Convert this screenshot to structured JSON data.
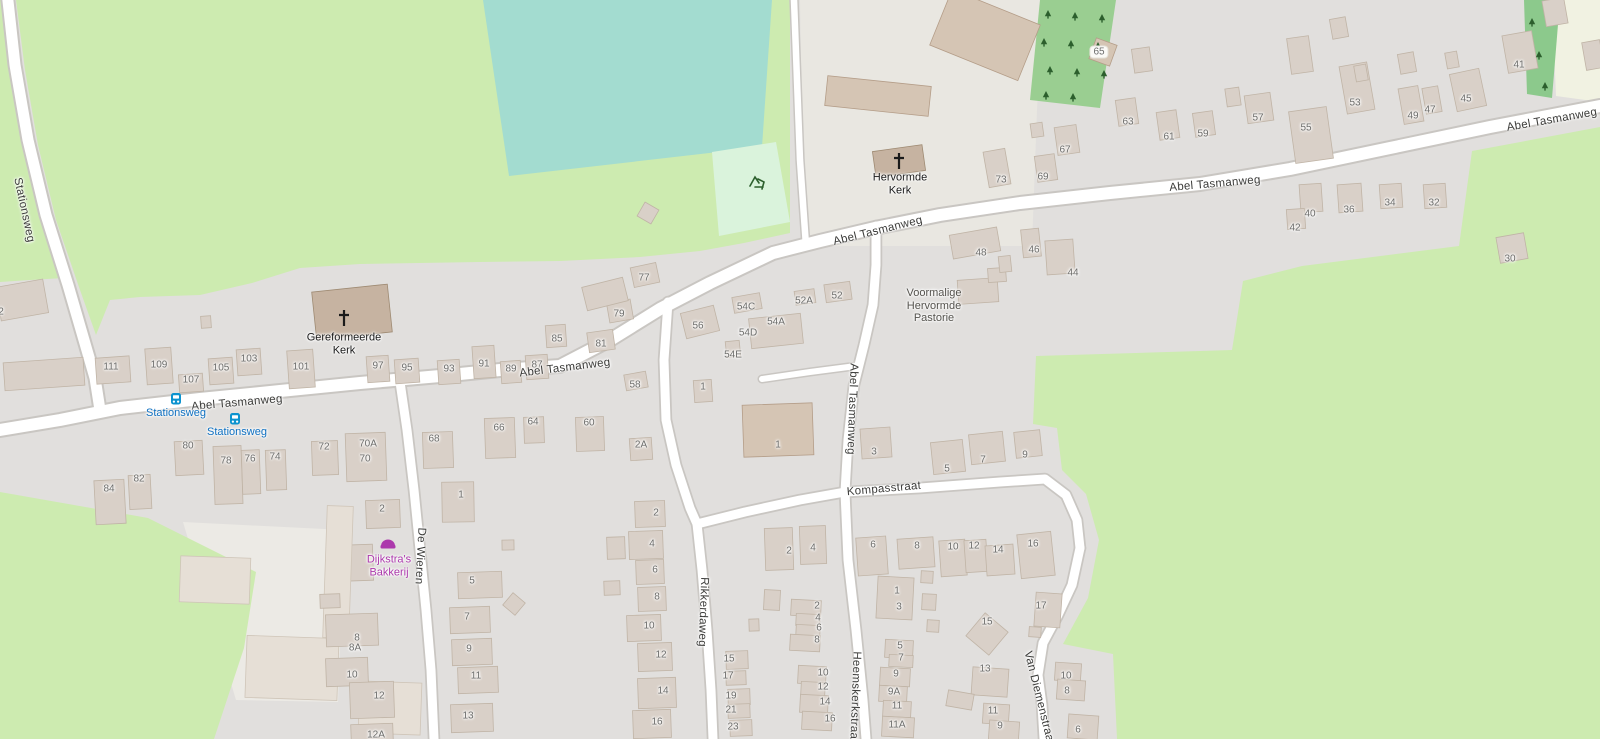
{
  "map": {
    "colors": {
      "residential": "#e1dfdd",
      "grass": "#cdebb0",
      "pitch": "#a3dcd0",
      "playground": "#daf3dc",
      "orchard": "#9ace91",
      "tree_strip": "#8cc98c",
      "tree_glyph": "#2c5f2d",
      "farmyard": "#e9e7e1",
      "farmland": "#f1f2e2",
      "yard": "#eceae5",
      "road_fill": "#ffffff",
      "road_casing": "#c9c6c2",
      "building_fill": "#d9d0c8",
      "building_stroke": "#c0b4a6",
      "shed_fill": "#d5c5b4",
      "shed_stroke": "#b49d88",
      "church_fill": "#c6b3a1",
      "church_stroke": "#9e8a72",
      "pale_fill": "#e6dfd6",
      "pale_stroke": "#cfc5b8",
      "street_text": "#3b3b39",
      "housenumber_text": "#6c6c6a",
      "church_text": "#1a1a1a",
      "site_text": "#54524d",
      "shop_purple": "#ac39ac",
      "bus_icon_blue": "#0c93cf",
      "bus_text_blue": "#0d6fc0"
    },
    "street_labels": [
      {
        "text": "Stationsweg",
        "x": 24,
        "y": 210,
        "rot": 78
      },
      {
        "text": "Abel Tasmanweg",
        "x": 237,
        "y": 403,
        "rot": -5
      },
      {
        "text": "Abel Tasmanweg",
        "x": 565,
        "y": 368,
        "rot": -7
      },
      {
        "text": "Abel Tasmanweg",
        "x": 878,
        "y": 231,
        "rot": -14
      },
      {
        "text": "Abel Tasmanweg",
        "x": 1215,
        "y": 184,
        "rot": -5
      },
      {
        "text": "Abel Tasmanweg",
        "x": 1552,
        "y": 120,
        "rot": -10
      },
      {
        "text": "Abel Tasmanweg",
        "x": 852,
        "y": 409,
        "rot": 92
      },
      {
        "text": "Kompasstraat",
        "x": 884,
        "y": 489,
        "rot": -5
      },
      {
        "text": "Rikkerdaweg",
        "x": 703,
        "y": 612,
        "rot": 92
      },
      {
        "text": "De Wieren",
        "x": 420,
        "y": 556,
        "rot": 93
      },
      {
        "text": "Heemskerkstraat",
        "x": 855,
        "y": 697,
        "rot": 92
      },
      {
        "text": "Van Diemenstraat",
        "x": 1039,
        "y": 698,
        "rot": 76
      }
    ],
    "pois": [
      {
        "id": "gereformeerde-kerk",
        "lines": [
          "Gereformeerde",
          "Kerk"
        ],
        "x": 344,
        "y": 344,
        "color": "church_text",
        "icon": "cross",
        "icon_x": 344,
        "icon_y": 318
      },
      {
        "id": "hervormde-kerk",
        "lines": [
          "Hervormde",
          "Kerk"
        ],
        "x": 900,
        "y": 184,
        "color": "church_text",
        "icon": "cross",
        "icon_x": 899,
        "icon_y": 161
      },
      {
        "id": "voormalige-hervormde-pastorie",
        "lines": [
          "Voormalige",
          "Hervormde",
          "Pastorie"
        ],
        "x": 934,
        "y": 306,
        "color": "site_text",
        "icon": "none"
      },
      {
        "id": "dijkstras-bakkerij",
        "lines": [
          "Dijkstra's",
          "Bakkerij"
        ],
        "x": 389,
        "y": 566,
        "color": "shop_purple",
        "icon": "bakery",
        "icon_x": 388,
        "icon_y": 544
      }
    ],
    "bus_stops": [
      {
        "label": "Stationsweg",
        "icon_x": 176,
        "icon_y": 399,
        "label_x": 176,
        "label_y": 413
      },
      {
        "label": "Stationsweg",
        "icon_x": 235,
        "icon_y": 419,
        "label_x": 237,
        "label_y": 432
      }
    ],
    "house_numbers": [
      {
        "n": "2",
        "x": 1,
        "y": 312
      },
      {
        "n": "111",
        "x": 111,
        "y": 367
      },
      {
        "n": "109",
        "x": 159,
        "y": 365
      },
      {
        "n": "107",
        "x": 191,
        "y": 380
      },
      {
        "n": "105",
        "x": 221,
        "y": 368
      },
      {
        "n": "103",
        "x": 249,
        "y": 359
      },
      {
        "n": "101",
        "x": 301,
        "y": 367
      },
      {
        "n": "97",
        "x": 378,
        "y": 366
      },
      {
        "n": "95",
        "x": 407,
        "y": 368
      },
      {
        "n": "93",
        "x": 449,
        "y": 369
      },
      {
        "n": "91",
        "x": 484,
        "y": 364
      },
      {
        "n": "89",
        "x": 511,
        "y": 369
      },
      {
        "n": "87",
        "x": 537,
        "y": 365
      },
      {
        "n": "85",
        "x": 557,
        "y": 339
      },
      {
        "n": "81",
        "x": 601,
        "y": 344
      },
      {
        "n": "79",
        "x": 619,
        "y": 314
      },
      {
        "n": "77",
        "x": 644,
        "y": 278
      },
      {
        "n": "56",
        "x": 698,
        "y": 326
      },
      {
        "n": "58",
        "x": 635,
        "y": 385
      },
      {
        "n": "54C",
        "x": 746,
        "y": 307
      },
      {
        "n": "54D",
        "x": 748,
        "y": 333
      },
      {
        "n": "54E",
        "x": 733,
        "y": 355
      },
      {
        "n": "54A",
        "x": 776,
        "y": 322
      },
      {
        "n": "52A",
        "x": 804,
        "y": 301
      },
      {
        "n": "52",
        "x": 837,
        "y": 296
      },
      {
        "n": "1",
        "x": 703,
        "y": 387
      },
      {
        "n": "65",
        "x": 1099,
        "y": 52,
        "boxed": true
      },
      {
        "n": "73",
        "x": 1001,
        "y": 180
      },
      {
        "n": "69",
        "x": 1043,
        "y": 177
      },
      {
        "n": "67",
        "x": 1065,
        "y": 150
      },
      {
        "n": "63",
        "x": 1128,
        "y": 122
      },
      {
        "n": "61",
        "x": 1169,
        "y": 137
      },
      {
        "n": "59",
        "x": 1203,
        "y": 134
      },
      {
        "n": "57",
        "x": 1258,
        "y": 118
      },
      {
        "n": "55",
        "x": 1306,
        "y": 128
      },
      {
        "n": "53",
        "x": 1355,
        "y": 103
      },
      {
        "n": "49",
        "x": 1413,
        "y": 116
      },
      {
        "n": "47",
        "x": 1430,
        "y": 110
      },
      {
        "n": "45",
        "x": 1466,
        "y": 99
      },
      {
        "n": "41",
        "x": 1519,
        "y": 65
      },
      {
        "n": "48",
        "x": 981,
        "y": 253
      },
      {
        "n": "46",
        "x": 1034,
        "y": 250
      },
      {
        "n": "44",
        "x": 1073,
        "y": 273
      },
      {
        "n": "40",
        "x": 1310,
        "y": 214
      },
      {
        "n": "42",
        "x": 1295,
        "y": 228
      },
      {
        "n": "36",
        "x": 1349,
        "y": 210
      },
      {
        "n": "34",
        "x": 1390,
        "y": 203
      },
      {
        "n": "32",
        "x": 1434,
        "y": 203
      },
      {
        "n": "30",
        "x": 1510,
        "y": 259
      },
      {
        "n": "84",
        "x": 109,
        "y": 489
      },
      {
        "n": "82",
        "x": 139,
        "y": 479
      },
      {
        "n": "80",
        "x": 188,
        "y": 446
      },
      {
        "n": "78",
        "x": 226,
        "y": 461
      },
      {
        "n": "76",
        "x": 250,
        "y": 459
      },
      {
        "n": "74",
        "x": 275,
        "y": 457
      },
      {
        "n": "72",
        "x": 324,
        "y": 447
      },
      {
        "n": "70A",
        "x": 368,
        "y": 444
      },
      {
        "n": "70",
        "x": 365,
        "y": 459
      },
      {
        "n": "2",
        "x": 382,
        "y": 509
      },
      {
        "n": "68",
        "x": 434,
        "y": 439
      },
      {
        "n": "66",
        "x": 499,
        "y": 428
      },
      {
        "n": "64",
        "x": 533,
        "y": 422
      },
      {
        "n": "60",
        "x": 589,
        "y": 423
      },
      {
        "n": "2A",
        "x": 641,
        "y": 445
      },
      {
        "n": "1",
        "x": 778,
        "y": 445
      },
      {
        "n": "1",
        "x": 461,
        "y": 495
      },
      {
        "n": "8",
        "x": 357,
        "y": 638
      },
      {
        "n": "8A",
        "x": 355,
        "y": 648
      },
      {
        "n": "10",
        "x": 352,
        "y": 675
      },
      {
        "n": "12",
        "x": 379,
        "y": 696
      },
      {
        "n": "12A",
        "x": 376,
        "y": 735
      },
      {
        "n": "5",
        "x": 472,
        "y": 581
      },
      {
        "n": "7",
        "x": 467,
        "y": 617
      },
      {
        "n": "9",
        "x": 469,
        "y": 649
      },
      {
        "n": "11",
        "x": 476,
        "y": 676
      },
      {
        "n": "13",
        "x": 468,
        "y": 716
      },
      {
        "n": "2",
        "x": 656,
        "y": 513
      },
      {
        "n": "4",
        "x": 652,
        "y": 544
      },
      {
        "n": "6",
        "x": 655,
        "y": 570
      },
      {
        "n": "8",
        "x": 657,
        "y": 597
      },
      {
        "n": "10",
        "x": 649,
        "y": 626
      },
      {
        "n": "12",
        "x": 661,
        "y": 655
      },
      {
        "n": "14",
        "x": 663,
        "y": 691
      },
      {
        "n": "16",
        "x": 657,
        "y": 722
      },
      {
        "n": "15",
        "x": 729,
        "y": 659
      },
      {
        "n": "17",
        "x": 728,
        "y": 676
      },
      {
        "n": "19",
        "x": 731,
        "y": 696
      },
      {
        "n": "21",
        "x": 731,
        "y": 710
      },
      {
        "n": "23",
        "x": 733,
        "y": 727
      },
      {
        "n": "2",
        "x": 789,
        "y": 551
      },
      {
        "n": "4",
        "x": 813,
        "y": 548
      },
      {
        "n": "2",
        "x": 817,
        "y": 606
      },
      {
        "n": "4",
        "x": 818,
        "y": 618
      },
      {
        "n": "6",
        "x": 819,
        "y": 628
      },
      {
        "n": "8",
        "x": 817,
        "y": 640
      },
      {
        "n": "10",
        "x": 823,
        "y": 673
      },
      {
        "n": "12",
        "x": 823,
        "y": 687
      },
      {
        "n": "14",
        "x": 825,
        "y": 702
      },
      {
        "n": "16",
        "x": 830,
        "y": 719
      },
      {
        "n": "1",
        "x": 897,
        "y": 591
      },
      {
        "n": "3",
        "x": 899,
        "y": 607
      },
      {
        "n": "5",
        "x": 900,
        "y": 646
      },
      {
        "n": "7",
        "x": 901,
        "y": 658
      },
      {
        "n": "9",
        "x": 896,
        "y": 674
      },
      {
        "n": "9A",
        "x": 894,
        "y": 692
      },
      {
        "n": "11",
        "x": 897,
        "y": 706
      },
      {
        "n": "11A",
        "x": 897,
        "y": 725
      },
      {
        "n": "3",
        "x": 874,
        "y": 452
      },
      {
        "n": "5",
        "x": 947,
        "y": 469
      },
      {
        "n": "7",
        "x": 983,
        "y": 460
      },
      {
        "n": "9",
        "x": 1025,
        "y": 455
      },
      {
        "n": "6",
        "x": 873,
        "y": 545
      },
      {
        "n": "8",
        "x": 917,
        "y": 546
      },
      {
        "n": "10",
        "x": 953,
        "y": 547
      },
      {
        "n": "12",
        "x": 974,
        "y": 546
      },
      {
        "n": "14",
        "x": 998,
        "y": 550
      },
      {
        "n": "16",
        "x": 1033,
        "y": 544
      },
      {
        "n": "15",
        "x": 987,
        "y": 622
      },
      {
        "n": "17",
        "x": 1041,
        "y": 606
      },
      {
        "n": "13",
        "x": 985,
        "y": 669
      },
      {
        "n": "11",
        "x": 993,
        "y": 711
      },
      {
        "n": "9",
        "x": 1000,
        "y": 726
      },
      {
        "n": "10",
        "x": 1066,
        "y": 676
      },
      {
        "n": "8",
        "x": 1067,
        "y": 691
      },
      {
        "n": "6",
        "x": 1078,
        "y": 730
      }
    ]
  }
}
